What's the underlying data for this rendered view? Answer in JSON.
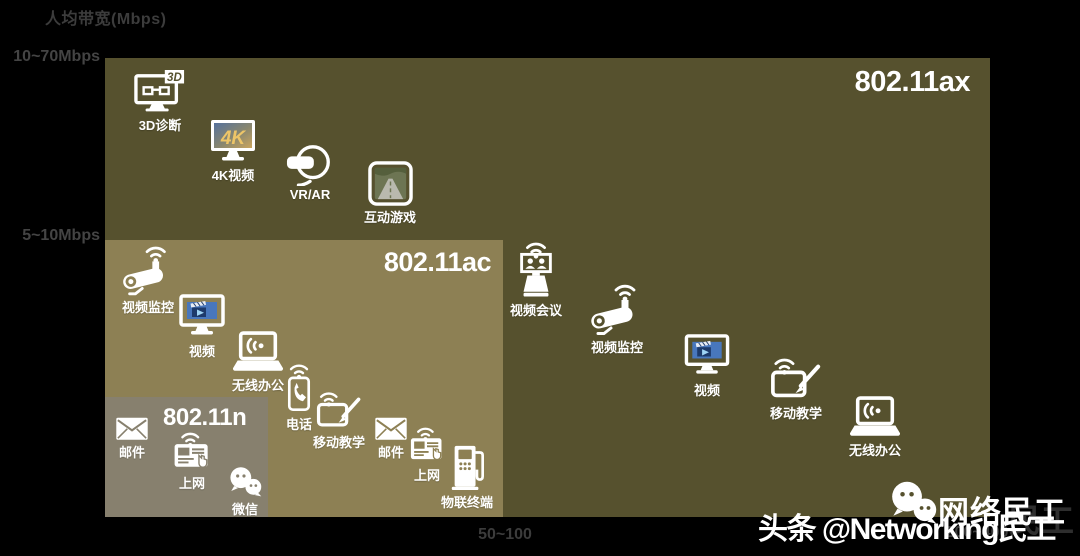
{
  "axes": {
    "y_label": "人均带宽(Mbps)",
    "y_ticks": [
      "10~70Mbps",
      "5~10Mbps"
    ],
    "x_ticks": [
      "50~100",
      "200~400"
    ]
  },
  "bands": [
    {
      "id": "ax",
      "label": "802.11ax",
      "color": "#56512e"
    },
    {
      "id": "ac",
      "label": "802.11ac",
      "color": "#8d8054"
    },
    {
      "id": "n",
      "label": "802.11n",
      "color": "#87806e"
    }
  ],
  "apps": [
    {
      "band": "ax",
      "label": "3D诊断",
      "icon": "monitor-3d-icon"
    },
    {
      "band": "ax",
      "label": "4K视频",
      "icon": "monitor-4k-icon"
    },
    {
      "band": "ax",
      "label": "VR/AR",
      "icon": "vr-headset-icon"
    },
    {
      "band": "ax",
      "label": "互动游戏",
      "icon": "game-screen-icon"
    },
    {
      "band": "ax",
      "label": "视频会议",
      "icon": "video-conference-icon"
    },
    {
      "band": "ax",
      "label": "视频监控",
      "icon": "cctv-camera-icon"
    },
    {
      "band": "ax",
      "label": "视频",
      "icon": "monitor-video-icon"
    },
    {
      "band": "ax",
      "label": "移动教学",
      "icon": "tablet-pen-icon"
    },
    {
      "band": "ax",
      "label": "无线办公",
      "icon": "laptop-wifi-icon"
    },
    {
      "band": "ac",
      "label": "视频监控",
      "icon": "cctv-camera-icon"
    },
    {
      "band": "ac",
      "label": "视频",
      "icon": "monitor-video-icon"
    },
    {
      "band": "ac",
      "label": "无线办公",
      "icon": "laptop-wifi-icon"
    },
    {
      "band": "ac",
      "label": "电话",
      "icon": "phone-wifi-icon"
    },
    {
      "band": "ac",
      "label": "移动教学",
      "icon": "tablet-pen-icon"
    },
    {
      "band": "ac",
      "label": "邮件",
      "icon": "envelope-icon"
    },
    {
      "band": "ac",
      "label": "上网",
      "icon": "tablet-browse-icon"
    },
    {
      "band": "ac",
      "label": "物联终端",
      "icon": "iot-terminal-icon"
    },
    {
      "band": "n",
      "label": "邮件",
      "icon": "envelope-icon"
    },
    {
      "band": "n",
      "label": "上网",
      "icon": "tablet-browse-icon"
    },
    {
      "band": "n",
      "label": "微信",
      "icon": "wechat-icon"
    }
  ],
  "watermark": {
    "toutiao_text": "头条 @Networking民工",
    "wechat_name": "网络民工",
    "echo_text": "民工"
  },
  "colors": {
    "background": "#000000",
    "tick_text": "#3c3c3c",
    "band_ax": "#56512e",
    "band_ac": "#8d8054",
    "band_n": "#87806e",
    "icon_white": "#ffffff"
  },
  "chart_data": {
    "type": "table",
    "title": "Wi-Fi 标准 / 人均带宽 / 应用场景",
    "ylabel": "人均带宽(Mbps)",
    "y_ranges": [
      "10~70Mbps",
      "5~10Mbps"
    ],
    "x_values": [
      "50~100",
      "200~400"
    ],
    "rows": [
      {
        "standard": "802.11n",
        "applications": [
          "邮件",
          "上网",
          "微信"
        ]
      },
      {
        "standard": "802.11ac",
        "applications": [
          "视频监控",
          "视频",
          "无线办公",
          "电话",
          "移动教学",
          "邮件",
          "上网",
          "物联终端"
        ]
      },
      {
        "standard": "802.11ax",
        "applications": [
          "3D诊断",
          "4K视频",
          "VR/AR",
          "互动游戏",
          "视频会议",
          "视频监控",
          "视频",
          "移动教学",
          "无线办公"
        ]
      }
    ]
  }
}
